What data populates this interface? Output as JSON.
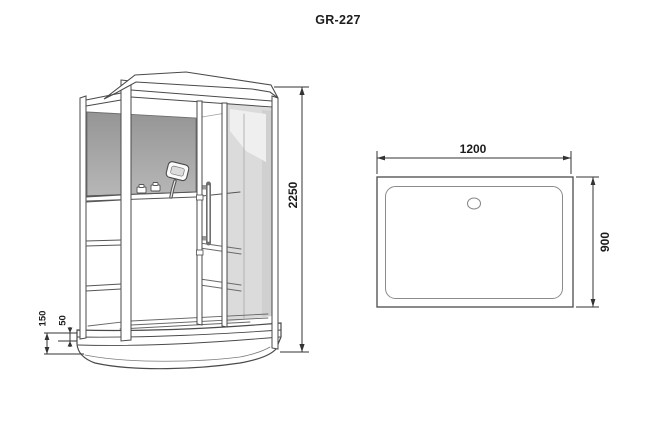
{
  "title": "GR-227",
  "front_view_dims": {
    "height": "2250",
    "tray_height": "150",
    "tray_step": "50"
  },
  "top_view_dims": {
    "width": "1200",
    "depth": "900"
  },
  "colors": {
    "line": "#4a4a4a",
    "dim_line": "#333333",
    "dim_text": "#1c1c1c",
    "back_panel_top": "#959595",
    "back_panel_bottom": "#b7b7b7",
    "glass_tint": "#dbdbdb",
    "glass_tint_dark": "#d0d0d0",
    "glass_reflection": "#efefef"
  }
}
